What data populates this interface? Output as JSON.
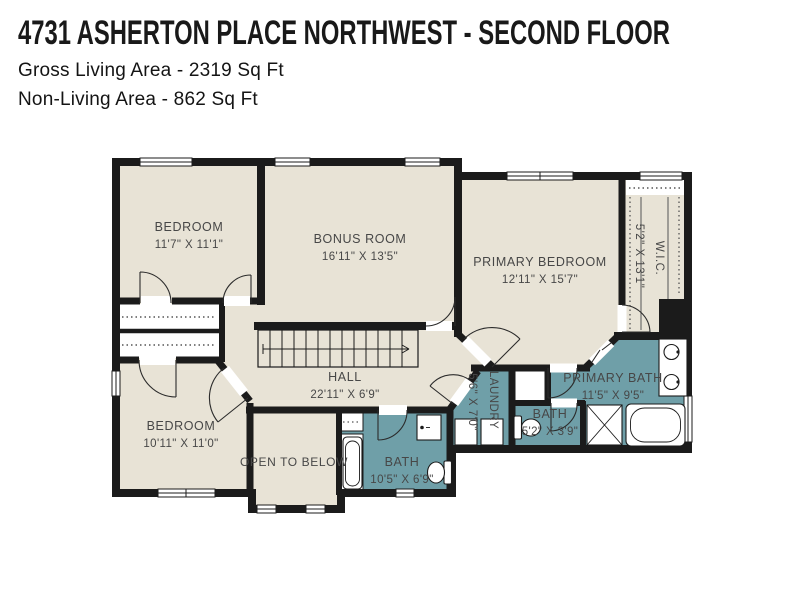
{
  "header": {
    "title": "4731 ASHERTON PLACE NORTHWEST - SECOND FLOOR",
    "lines": [
      "Gross Living Area - 2319 Sq Ft",
      "Non-Living Area - 862 Sq Ft"
    ]
  },
  "rooms": {
    "bedroom_tl": {
      "name": "BEDROOM",
      "dims": "11'7\" X 11'1\""
    },
    "bonus_room": {
      "name": "BONUS ROOM",
      "dims": "16'11\" X 13'5\""
    },
    "primary_bedroom": {
      "name": "PRIMARY BEDROOM",
      "dims": "12'11\" X 15'7\""
    },
    "wic": {
      "name": "W.I.C.",
      "dims": "5'2\" X 13'1\""
    },
    "hall": {
      "name": "HALL",
      "dims": "22'11\" X 6'9\""
    },
    "bedroom_bl": {
      "name": "BEDROOM",
      "dims": "10'11\" X 11'0\""
    },
    "open_to_below": {
      "name": "OPEN TO BELOW"
    },
    "bath": {
      "name": "BATH",
      "dims": "10'5\" X 6'9\""
    },
    "laundry": {
      "name": "LAUNDRY",
      "dims": "5'6\" X 7'0\""
    },
    "primary_bath": {
      "name": "PRIMARY BATH",
      "dims": "11'5\" X 9'5\""
    },
    "bath_small": {
      "name": "BATH",
      "dims": "5'2\" X 3'9\""
    }
  },
  "colors": {
    "background": "#ffffff",
    "floor": "#e8e3d6",
    "wet_floor": "#6f9fa8",
    "wall": "#1b1b1b",
    "label_text": "#474747"
  }
}
